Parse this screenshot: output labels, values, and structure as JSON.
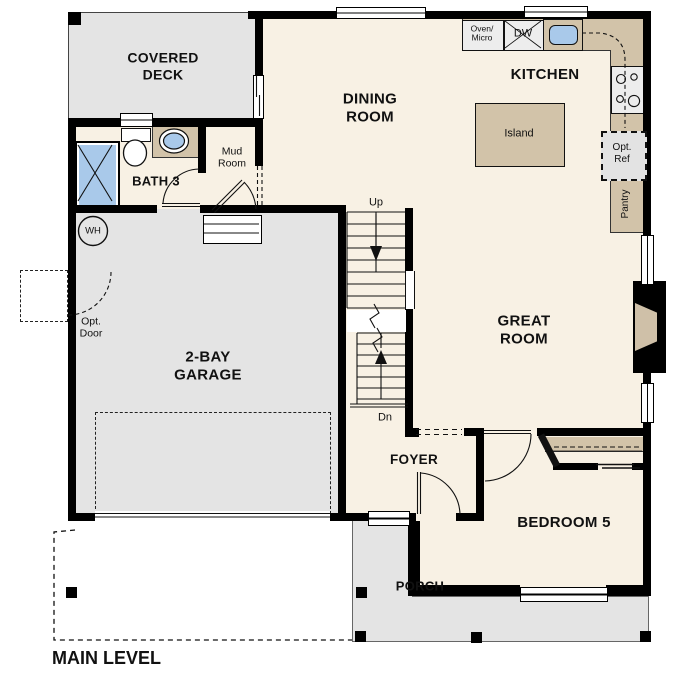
{
  "plan": {
    "title": "MAIN LEVEL",
    "rooms": {
      "covered_deck": "COVERED\nDECK",
      "dining_room": "DINING\nROOM",
      "kitchen": "KITCHEN",
      "great_room": "GREAT\nROOM",
      "garage": "2-BAY\nGARAGE",
      "bath3": "BATH 3",
      "mud_room": "Mud\nRoom",
      "foyer": "FOYER",
      "bedroom5": "BEDROOM 5",
      "porch": "PORCH"
    },
    "features": {
      "island": "Island",
      "oven_micro": "Oven/\nMicro",
      "dishwasher": "DW",
      "opt_ref": "Opt.\nRef",
      "pantry": "Pantry",
      "water_heater": "WH",
      "opt_door": "Opt.\nDoor",
      "stairs_up": "Up",
      "stairs_down": "Dn"
    },
    "colors": {
      "room_fill": "#f8f1e4",
      "outdoor_fill": "#e4e4e4",
      "counter_fill": "#d2c3a9",
      "water_fill": "#a9c9ea",
      "appliance_fill": "#ededed",
      "wall": "#000000"
    }
  }
}
